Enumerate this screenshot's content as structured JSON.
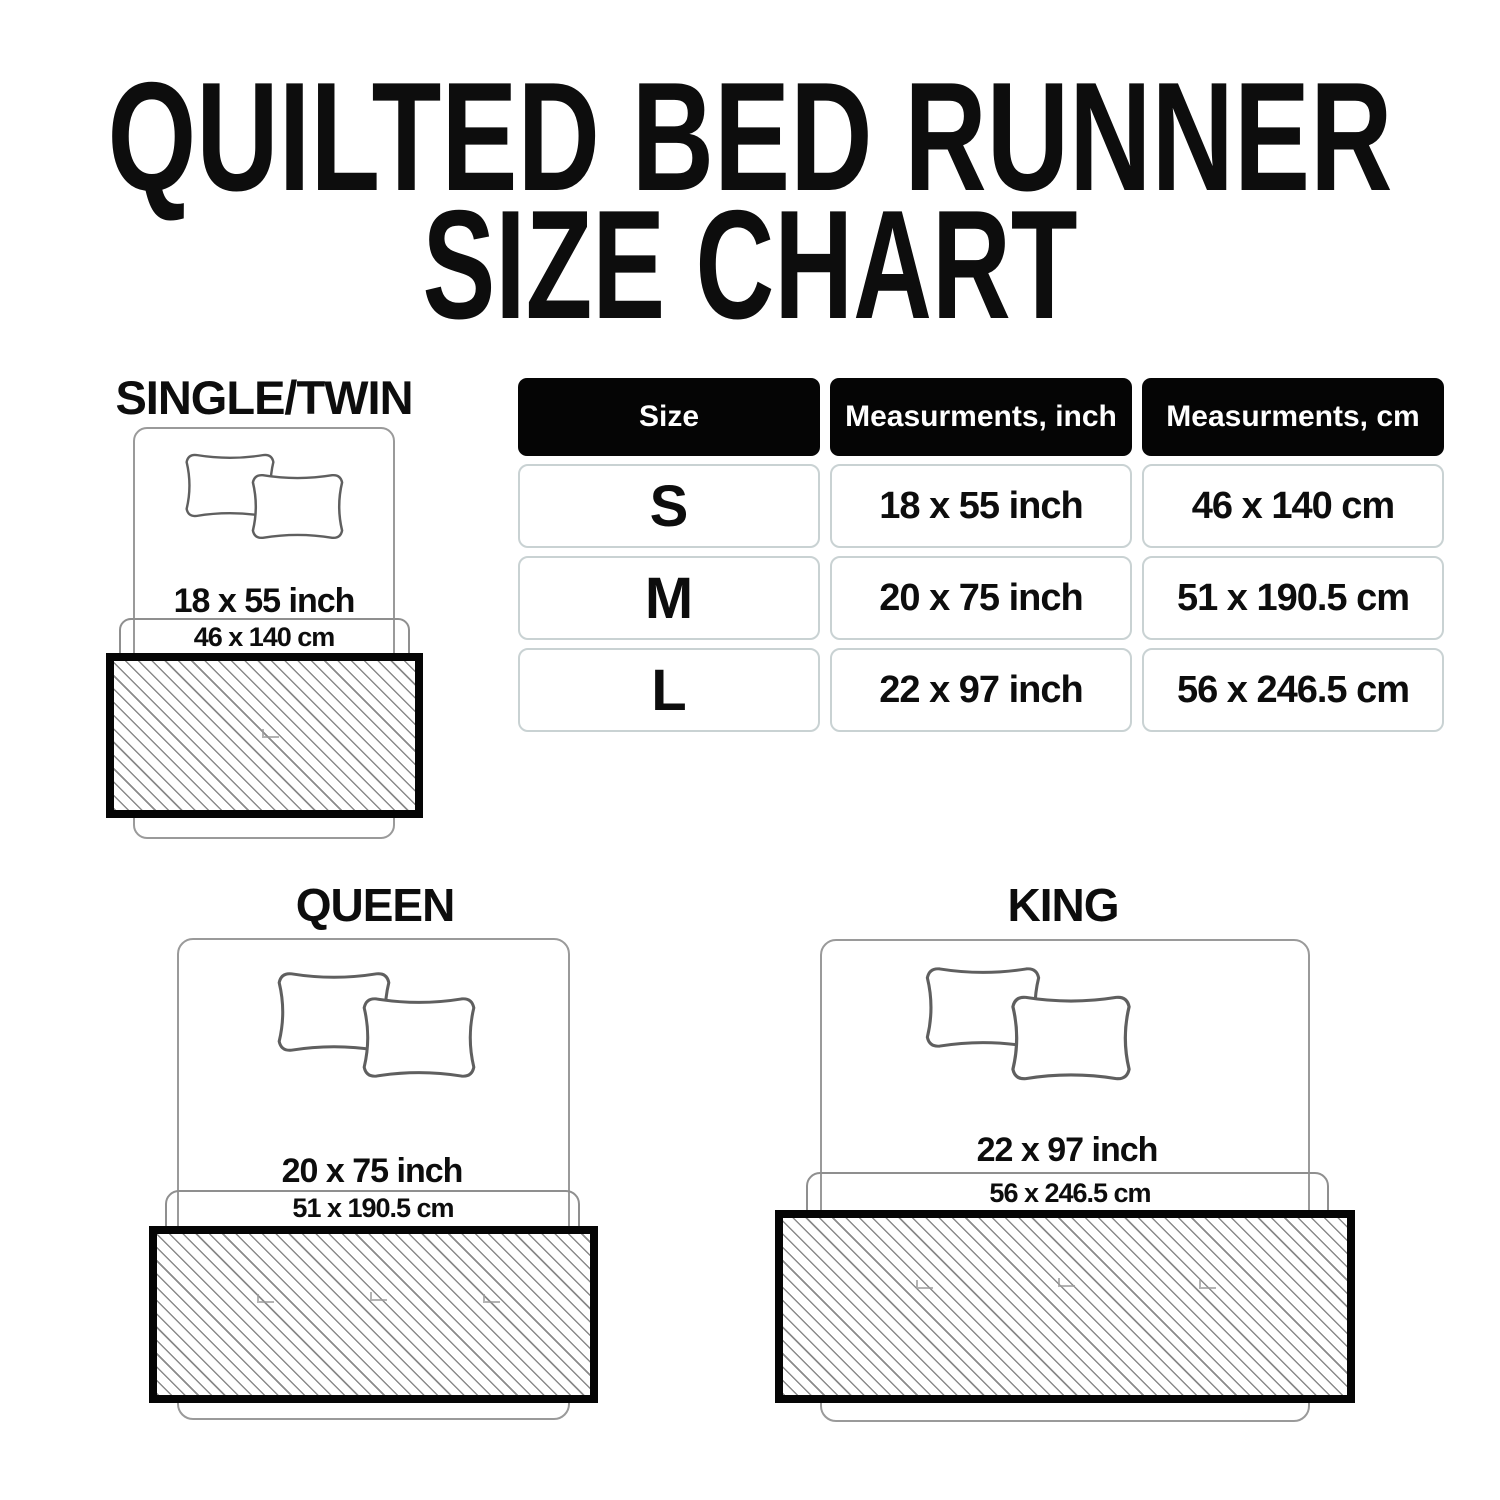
{
  "title": {
    "line1": "QUILTED BED RUNNER",
    "line2": "SIZE CHART"
  },
  "table": {
    "headers": [
      "Size",
      "Measurments, inch",
      "Measurments, cm"
    ],
    "rows": [
      {
        "size": "S",
        "inch": "18 x 55 inch",
        "cm": "46 x 140 cm"
      },
      {
        "size": "M",
        "inch": "20 x 75 inch",
        "cm": "51 x 190.5 cm"
      },
      {
        "size": "L",
        "inch": "22 x 97 inch",
        "cm": "56 x 246.5 cm"
      }
    ]
  },
  "diagrams": [
    {
      "label": "SINGLE/TWIN",
      "inch_label": "18 x 55 inch",
      "cm_label": "46 x 140 cm"
    },
    {
      "label": "QUEEN",
      "inch_label": "20 x 75 inch",
      "cm_label": "51 x 190.5 cm"
    },
    {
      "label": "KING",
      "inch_label": "22 x 97 inch",
      "cm_label": "56 x 246.5 cm"
    }
  ],
  "colors": {
    "text": "#0d0d0d",
    "table_header_bg": "#050505",
    "table_header_text": "#ffffff",
    "table_cell_border": "#c9d2d3",
    "bed_outline": "#9a9a9a",
    "zone_outline": "#8f8f8f",
    "pillow_outline": "#5f5f5f",
    "runner_border": "#050505",
    "hatch_line": "#8a8a8a"
  }
}
